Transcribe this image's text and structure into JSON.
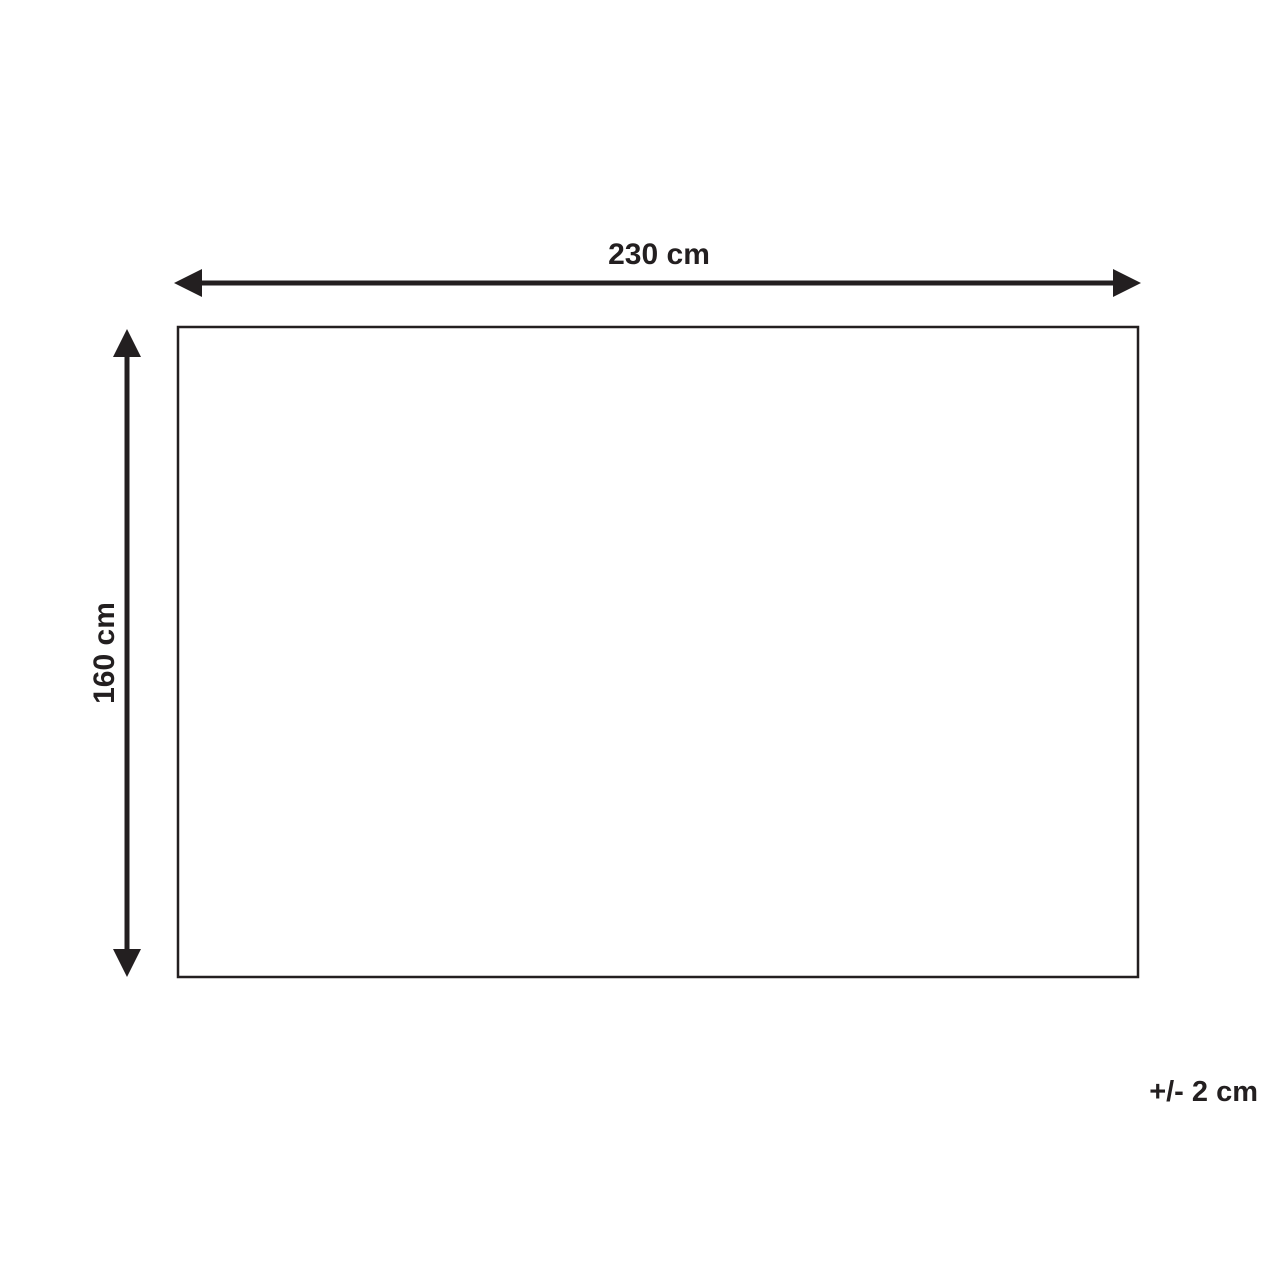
{
  "diagram": {
    "width_label": "230 cm",
    "height_label": "160 cm",
    "tolerance_label": "+/- 2 cm",
    "line_color": "#231f20",
    "background_color": "#ffffff",
    "shape": "rectangle"
  }
}
